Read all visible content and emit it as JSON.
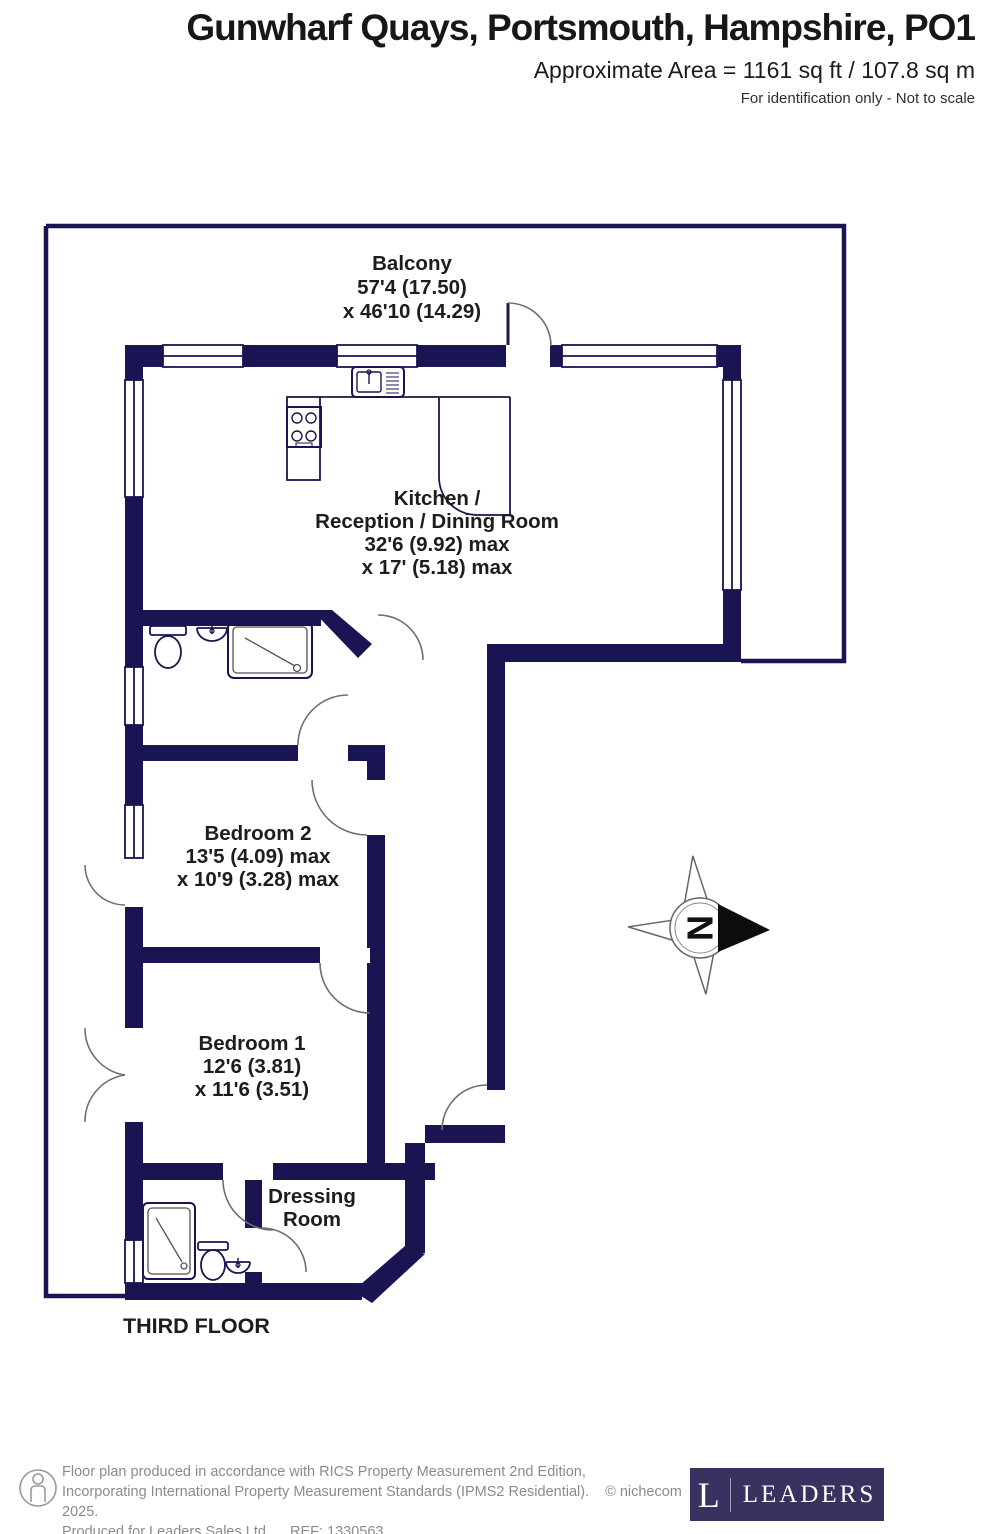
{
  "header": {
    "title": "Gunwharf Quays, Portsmouth, Hampshire, PO1",
    "area": "Approximate Area = 1161 sq ft / 107.8 sq m",
    "note": "For identification only - Not to scale"
  },
  "plan": {
    "floor_label": "THIRD FLOOR",
    "compass_north": "N",
    "rooms": {
      "balcony": {
        "name": "Balcony",
        "dim_line1": "57'4 (17.50)",
        "dim_line2": "x 46'10 (14.29)"
      },
      "kitchen": {
        "name_line1": "Kitchen /",
        "name_line2": "Reception / Dining Room",
        "dim_line1": "32'6 (9.92) max",
        "dim_line2": "x 17' (5.18) max"
      },
      "bedroom2": {
        "name": "Bedroom 2",
        "dim_line1": "13'5 (4.09) max",
        "dim_line2": "x 10'9 (3.28) max"
      },
      "bedroom1": {
        "name": "Bedroom 1",
        "dim_line1": "12'6 (3.81)",
        "dim_line2": "x 11'6 (3.51)"
      },
      "dressing_room": {
        "name_line1": "Dressing",
        "name_line2": "Room"
      }
    },
    "colors": {
      "wall_navy": "#191552",
      "label_text": "#1d1d1d",
      "door_arc": "#707070"
    }
  },
  "footer": {
    "line1": "Floor plan produced in accordance with RICS Property Measurement 2nd Edition,",
    "line2": "Incorporating International Property Measurement Standards (IPMS2 Residential).",
    "copyright": "© nichecom 2025.",
    "line3": "Produced for Leaders Sales Ltd.",
    "ref": "REF:  1330563",
    "colors": {
      "text": "#8b8b8b",
      "logo_bg": "#3a3161"
    }
  },
  "logo": {
    "letter": "L",
    "name": "LEADERS"
  }
}
